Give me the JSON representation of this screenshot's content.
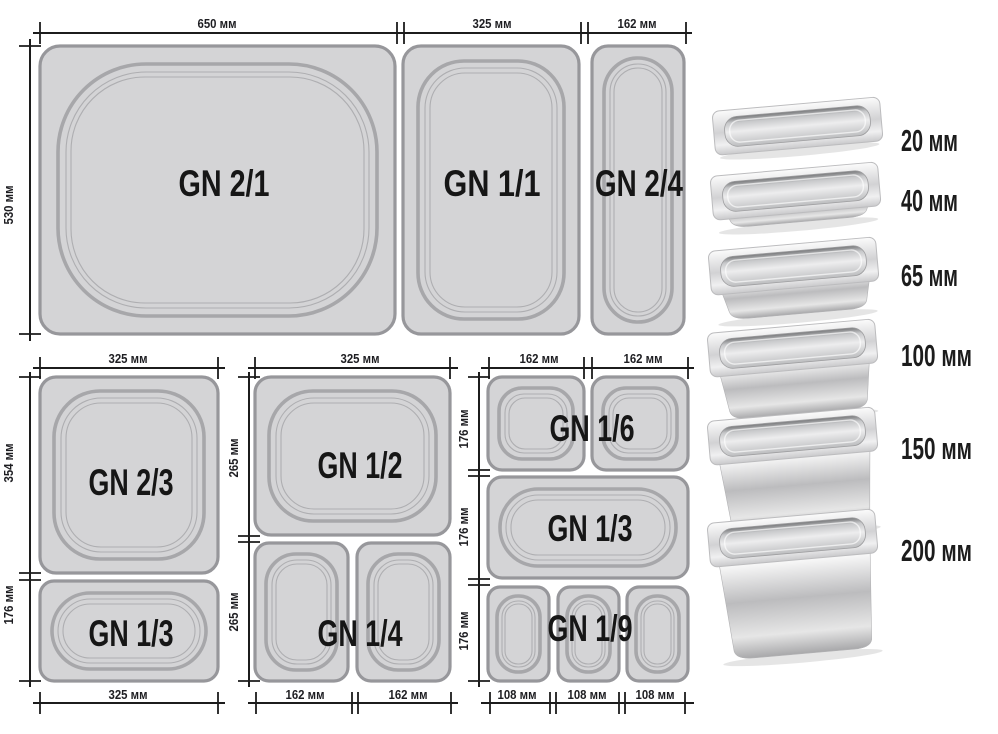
{
  "diagram": {
    "top_row": {
      "height_dim": "530 мм",
      "pans": [
        {
          "name": "GN 2/1",
          "width_dim": "650 мм"
        },
        {
          "name": "GN 1/1",
          "width_dim": "325 мм"
        },
        {
          "name": "GN 2/4",
          "width_dim": "162 мм"
        }
      ]
    },
    "bottom_left_group": {
      "top_width_dim": "325 мм",
      "bottom_width_dim": "325 мм",
      "pans": [
        {
          "name": "GN 2/3",
          "height_dim": "354 мм"
        },
        {
          "name": "GN 1/3",
          "height_dim": "176 мм"
        }
      ]
    },
    "bottom_middle_group": {
      "top_width_dim": "325 мм",
      "pans": [
        {
          "name": "GN 1/2",
          "height_dim": "265 мм"
        },
        {
          "name": "GN 1/4",
          "height_dim": "265 мм"
        }
      ],
      "bottom_width_dims": [
        "162 мм",
        "162 мм"
      ]
    },
    "bottom_right_group": {
      "top_width_dims": [
        "162 мм",
        "162 мм"
      ],
      "rows": [
        {
          "name": "GN 1/6",
          "height_dim": "176 мм"
        },
        {
          "name": "GN 1/3",
          "height_dim": "176 мм"
        },
        {
          "name": "GN 1/9",
          "height_dim": "176 мм"
        }
      ],
      "bottom_width_dims": [
        "108 мм",
        "108 мм",
        "108 мм"
      ]
    }
  },
  "depth_column": {
    "items": [
      {
        "depth": "20 мм"
      },
      {
        "depth": "40 мм"
      },
      {
        "depth": "65 мм"
      },
      {
        "depth": "100 мм"
      },
      {
        "depth": "150 мм"
      },
      {
        "depth": "200 мм"
      }
    ]
  },
  "colors": {
    "pan_fill": "#d4d4d6",
    "pan_border": "#97979b",
    "dim_line": "#1c1c1c",
    "background": "#ffffff"
  }
}
